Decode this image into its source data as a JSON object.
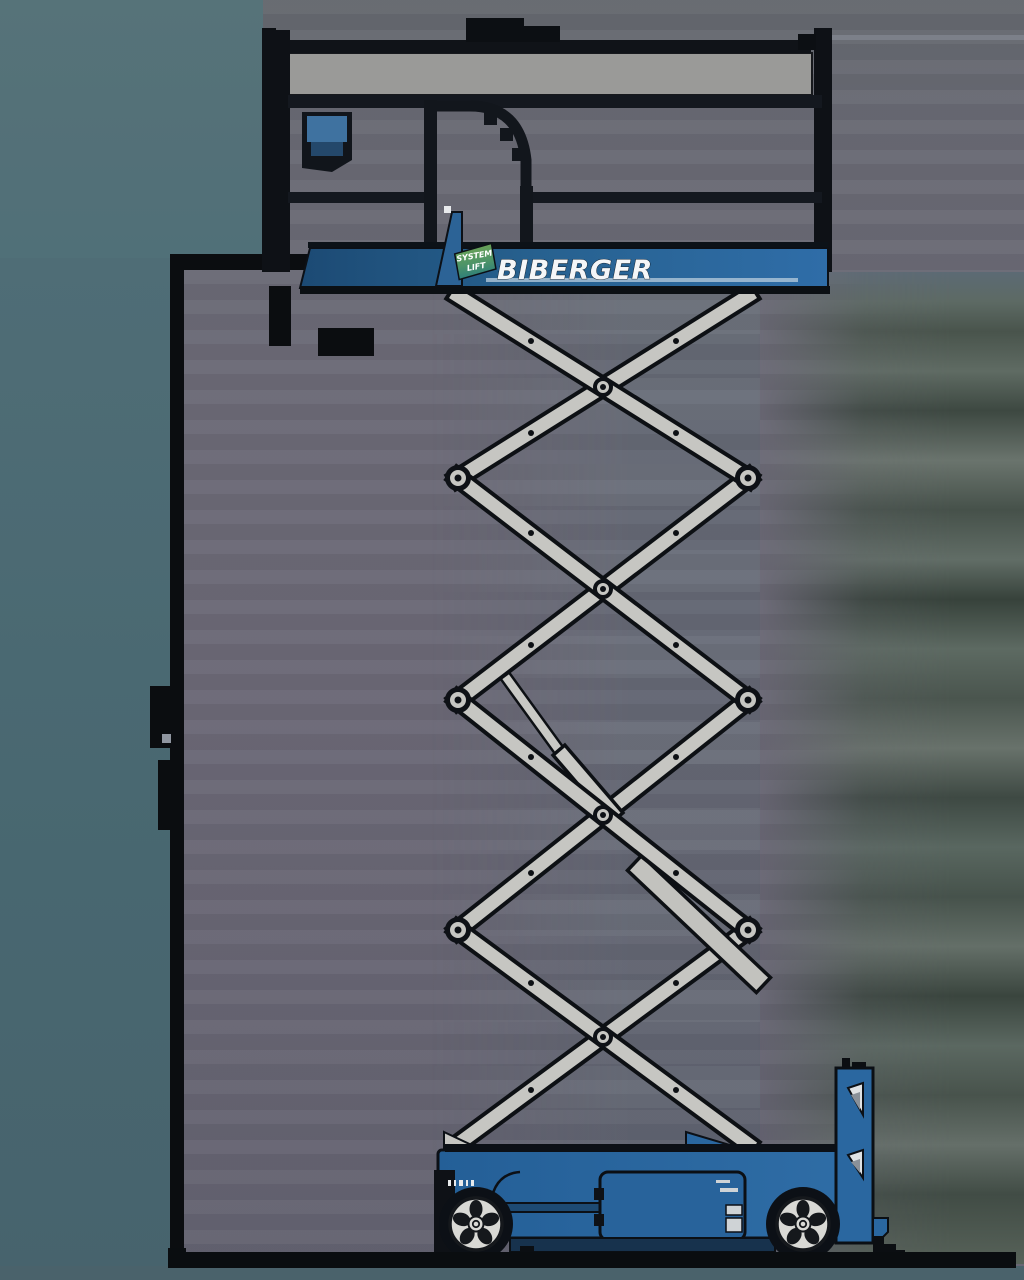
{
  "machine": {
    "brand_label": "BIBERGER",
    "badge": {
      "top": "SYSTEM",
      "bottom": "LIFT"
    },
    "scissor_sections": 4,
    "wheel_count": 2,
    "colors": {
      "platform_blue": "#2b6aa2",
      "chassis_blue": "#2d6ba4",
      "arm_gray": "#c6c6c2",
      "outline_dark": "#0d1014",
      "wheel_rim": "#d9d9d5",
      "badge_green": "#5d9a57",
      "badge_teal": "#2e7f7a"
    }
  },
  "background": {
    "left_panel_teal": "#527077",
    "main_gray_violet": "#6b6875",
    "right_band_greens": [
      "#5f6b63",
      "#414c45",
      "#6a746d",
      "#37423b"
    ],
    "ground_black": "#0a0d10"
  }
}
